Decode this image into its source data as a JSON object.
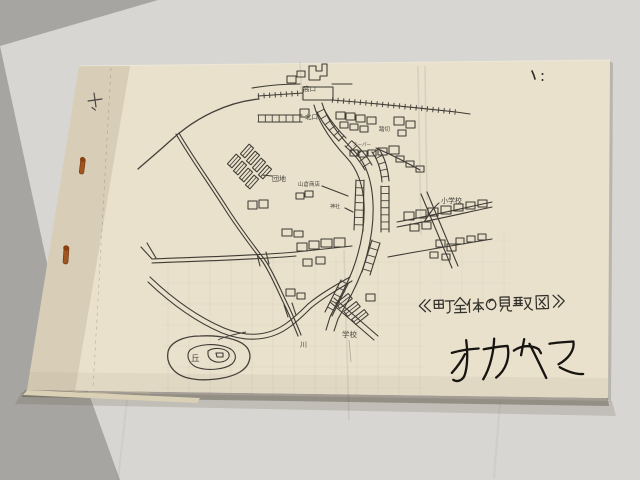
{
  "photo": {
    "description": "Photograph of a stapled mimeograph booklet page bearing a hand-drawn Japanese town map",
    "surface_color": "#a7a5a1",
    "backing_sheet_color": "#d8d6d2",
    "paper_color": "#e9e1cc",
    "ink_color": "#3f3b35",
    "pen_ink_color": "#171411",
    "brad_color": "#a2561f"
  },
  "page": {
    "title": "《町全体の見取図》",
    "signature": "オカヤマ",
    "corner_mark": "ヽ :",
    "plus_mark": "+"
  },
  "map_labels": {
    "station_exit": "高口",
    "north_exit": "北口",
    "rail_crossing": "踏切",
    "supermarket": "スーパー",
    "housing_complex": "団地",
    "shop": "山倉商店",
    "shrine": "神社",
    "elementary_school": "小学校",
    "school": "学校",
    "river": "川",
    "hill": "丘"
  }
}
